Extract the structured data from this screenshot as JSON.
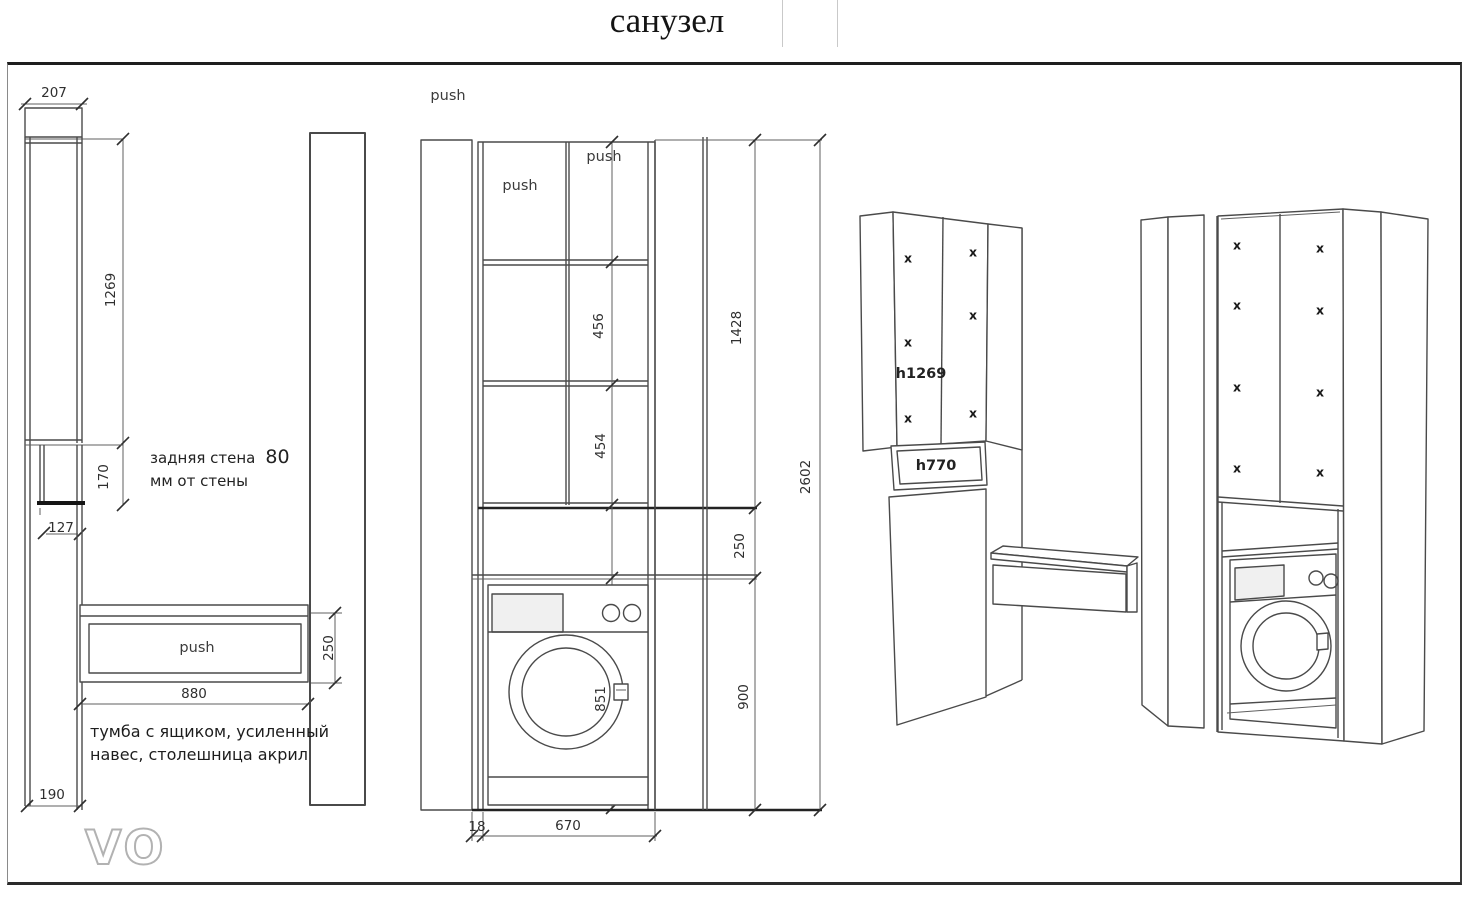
{
  "title": "санузел",
  "labels": {
    "push": "push",
    "x": "x",
    "h_upper_cabinet": "h1269",
    "h_mirror_panel": "h770"
  },
  "notes": {
    "back_wall_prefix": "задняя стена",
    "back_wall_value": "80",
    "back_wall_line2": "мм  от стены",
    "vanity_line1": "тумба с ящиком, усиленный",
    "vanity_line2": "навес, столешница акрил"
  },
  "side_view": {
    "top_depth": "207",
    "upper_height": "1269",
    "apron_height": "170",
    "wall_offset": "127",
    "vanity_width": "880",
    "vanity_height": "250",
    "plinth_height": "190"
  },
  "front_view": {
    "shelf_gap_1": "456",
    "shelf_gap_2": "454",
    "upper_zone_height": "1428",
    "mid_gap": "250",
    "total_height": "2602",
    "washer_zone_height": "900",
    "niche_height": "851",
    "niche_width": "670",
    "side_gap": "18"
  },
  "logo": {
    "text": "VO"
  },
  "colors": {
    "line": "#4a4a4a",
    "accent_dark": "#1a1a1a",
    "logo_gray": "#9d9d9d",
    "logo_bar": "#868686"
  }
}
